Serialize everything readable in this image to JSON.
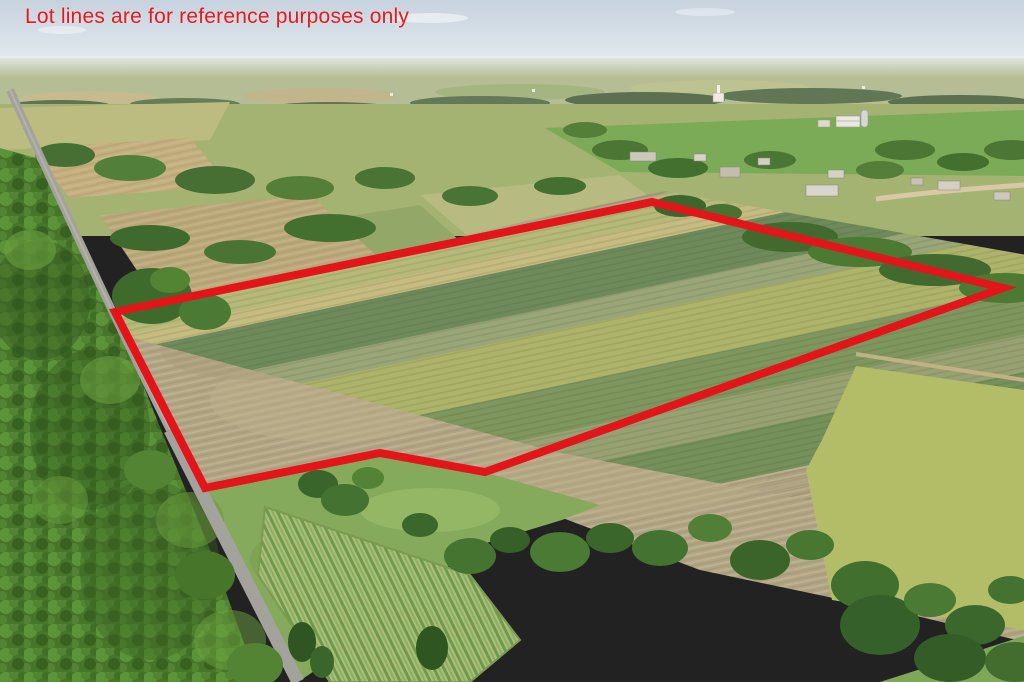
{
  "annotation": {
    "caption": "Lot lines are for reference purposes only",
    "caption_color": "#e8191c",
    "boundary_color": "#e3141a",
    "boundary_stroke_width": 8,
    "lot_boundary_points": "115,312 652,202 1003,288 485,472 380,453 205,488"
  },
  "scene": {
    "palette": {
      "sky": "#cbd7e2",
      "distant_haze": "#b4bd93",
      "pasture_green": "#7cab57",
      "crop_green": "#6e8a5a",
      "crop_yellow_green": "#aeb36a",
      "stubble_tan": "#b0a483",
      "forest_green": "#47762a",
      "road_gray": "#a3a29c",
      "meadow_grass": "#85aa5b"
    }
  }
}
